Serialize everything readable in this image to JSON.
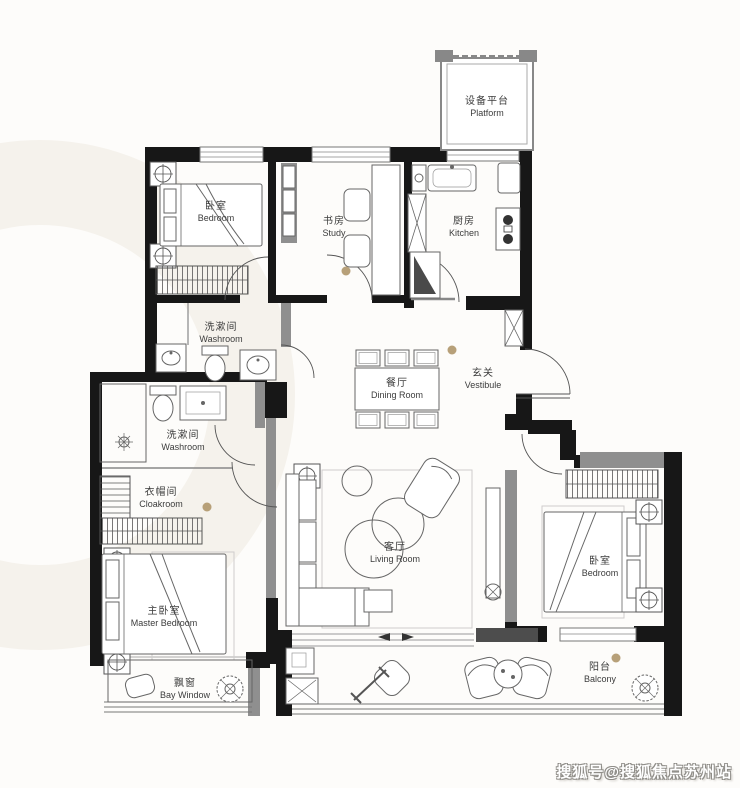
{
  "watermark": {
    "text": "搜狐号@搜狐焦点苏州站"
  },
  "colors": {
    "background": "#fdfcfa",
    "wall": "#171717",
    "secondary_wall": "#8f8f8f",
    "furniture_line": "#666666",
    "accent_dot": "#b39b72"
  },
  "rooms": {
    "bedroom_top": {
      "zh": "卧室",
      "en": "Bedroom"
    },
    "study": {
      "zh": "书房",
      "en": "Study"
    },
    "kitchen": {
      "zh": "厨房",
      "en": "Kitchen"
    },
    "platform": {
      "zh": "设备平台",
      "en": "Platform"
    },
    "washroom_upper": {
      "zh": "洗漱间",
      "en": "Washroom"
    },
    "washroom_lower": {
      "zh": "洗漱间",
      "en": "Washroom"
    },
    "dining": {
      "zh": "餐厅",
      "en": "Dining Room"
    },
    "vestibule": {
      "zh": "玄关",
      "en": "Vestibule"
    },
    "cloakroom": {
      "zh": "衣帽间",
      "en": "Cloakroom"
    },
    "master_bedroom": {
      "zh": "主卧室",
      "en": "Master Bedroom"
    },
    "living": {
      "zh": "客厅",
      "en": "Living Room"
    },
    "bedroom_right": {
      "zh": "卧室",
      "en": "Bedroom"
    },
    "bay_window": {
      "zh": "飘窗",
      "en": "Bay Window"
    },
    "balcony": {
      "zh": "阳台",
      "en": "Balcony"
    }
  }
}
